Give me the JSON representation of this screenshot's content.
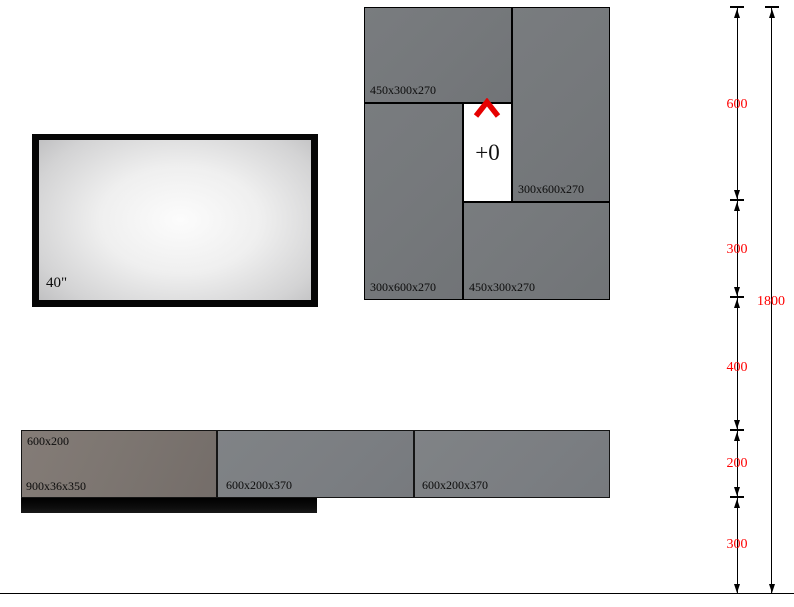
{
  "tv": {
    "size_label": "40\""
  },
  "wall_cabinets": {
    "top_left": {
      "label": "450x300x270"
    },
    "top_right": {
      "label": "300x600x270"
    },
    "bottom_left": {
      "label": "300x600x270"
    },
    "bottom_right": {
      "label": "450x300x270"
    }
  },
  "niche": {
    "level_label": "+0"
  },
  "base_cabinets": {
    "left": {
      "top_label": "600x200",
      "bottom_label": "900x36x350"
    },
    "middle": {
      "label": "600x200x370"
    },
    "right": {
      "label": "600x200x370"
    }
  },
  "dimensions": {
    "segments": [
      "600",
      "300",
      "400",
      "200",
      "300"
    ],
    "total": "1800",
    "text_color": "#ff0000"
  },
  "colors": {
    "cabinet_gray": "#75787b",
    "base_left_brown": "#7d7671",
    "marker_red": "#e60000",
    "background": "#ffffff"
  }
}
